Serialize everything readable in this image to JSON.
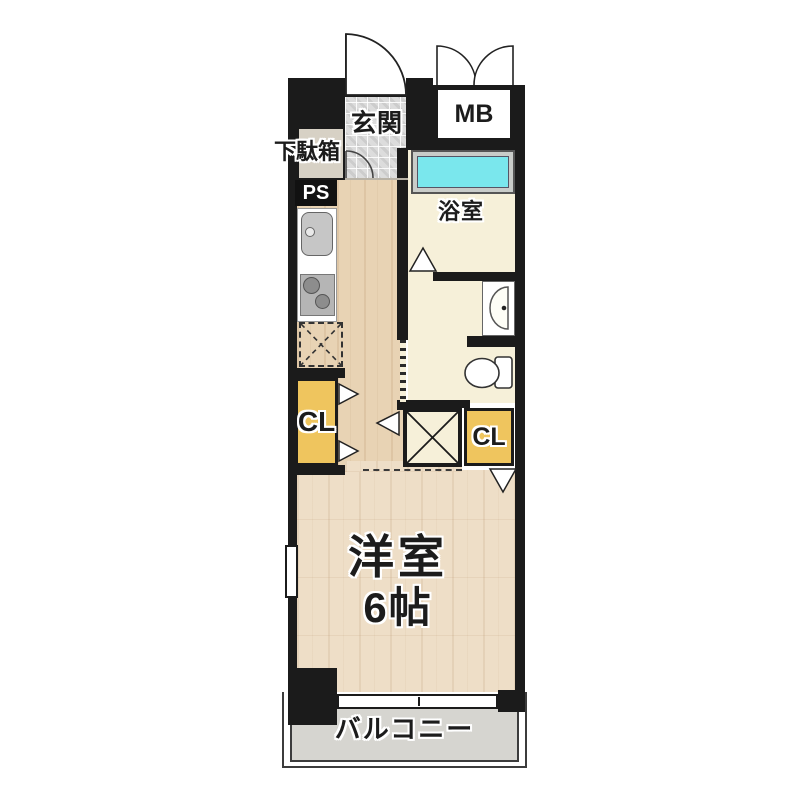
{
  "title": "apartment-floor-plan",
  "labels": {
    "entrance": "玄関",
    "shoe_cabinet": "下駄箱",
    "pipe_space": "PS",
    "meter_box": "MB",
    "bathroom": "浴室",
    "closet_left": "CL",
    "closet_right": "CL",
    "room_name": "洋室",
    "room_size": "6帖",
    "balcony": "バルコニー"
  },
  "colors": {
    "wall": "#1b1b1b",
    "wood-hall": "#e8d3b4",
    "wood-room": "#eedec7",
    "tile": "#dcdcdc",
    "cream": "#f6f0d9",
    "tub": "#7ae7ed",
    "closet": "#efc55e",
    "balcony": "#d6d5d0",
    "fixture": "#c6c6c6",
    "label": "#1c1c1c"
  },
  "icons": {
    "entrance-door": "quarter-arc door swing",
    "meter-box-doors": "double quarter-arc swing",
    "interior-door-swing": "quarter-arc",
    "folding-door": "triangle leaf",
    "kitchen-sink": "rounded basin with faucet dot",
    "stove": "two burner circles",
    "refrigerator-space": "dashed box with X",
    "washing-machine-space": "box with X",
    "bathtub": "rimmed rectangular tub",
    "washbasin": "half-oval basin with drain dot",
    "toilet": "bowl with tank",
    "sliding-window": "split white bar",
    "window": "white slot in wall",
    "accordion-door": "dashed strip"
  }
}
